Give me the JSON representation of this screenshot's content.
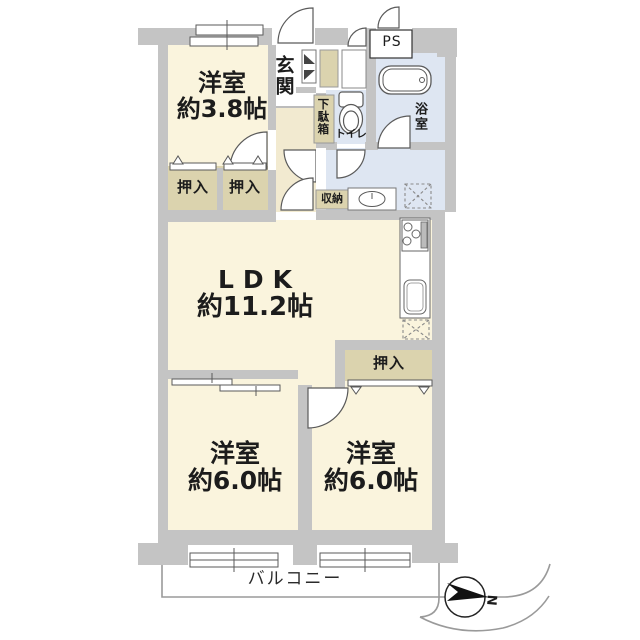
{
  "plan_title": "apartment-floor-plan",
  "rooms": {
    "bedroom_small": {
      "name": "洋室",
      "size": "約3.8帖"
    },
    "ldk": {
      "name": "LDK",
      "size": "約11.2帖"
    },
    "bedroom_left": {
      "name": "洋室",
      "size": "約6.0帖"
    },
    "bedroom_right": {
      "name": "洋室",
      "size": "約6.0帖"
    },
    "entrance": {
      "name": "玄関"
    },
    "shoe_cabinet": {
      "name": "下駄箱"
    },
    "toilet": {
      "name": "トイレ"
    },
    "bathroom": {
      "name": "浴室"
    },
    "storage": {
      "name": "収納"
    },
    "closet_a": {
      "name": "押入"
    },
    "closet_b": {
      "name": "押入"
    },
    "closet_c": {
      "name": "押入"
    },
    "pipe_space": {
      "name": "PS"
    },
    "balcony": {
      "name": "バルコニー"
    }
  },
  "compass": {
    "label": "N"
  },
  "colors": {
    "floor_cream": "#faf4dd",
    "floor_tan": "#dbd3ae",
    "floor_hall": "#f2ead0",
    "floor_wet_blue": "#dee6f2",
    "wall_grey": "#c4c4c4",
    "fixture_line": "#5a5a5a",
    "balcony_line": "#9a9a9a",
    "text": "#1c1c1c"
  }
}
